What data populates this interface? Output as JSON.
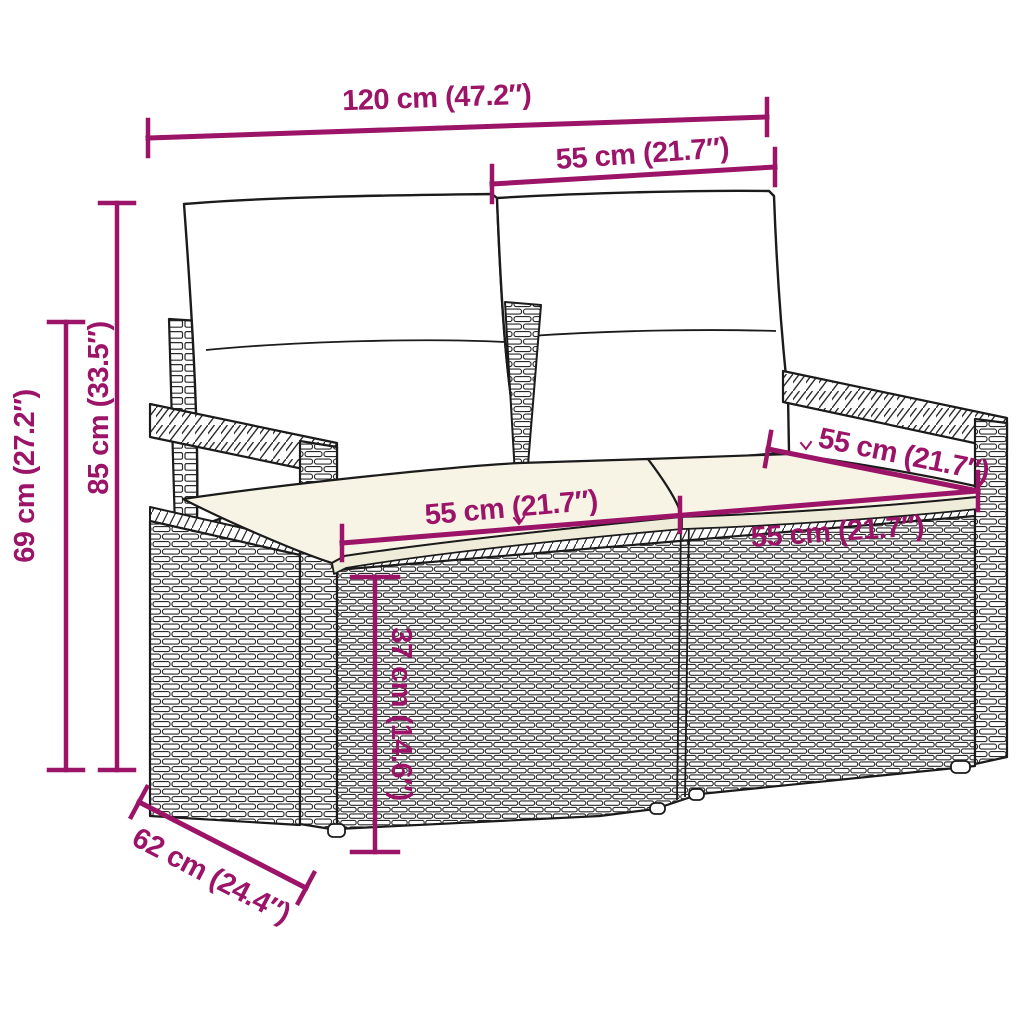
{
  "figure": {
    "kind": "product dimension diagram",
    "subject": "poly rattan garden loveseat (2-seater) with back and seat cushions"
  },
  "colors": {
    "dimension_magenta": "#9B1468",
    "outline_black": "#1b1b1b",
    "cushion_cream_top": "#F7F4E6",
    "cushion_cream_side": "#EFECDA",
    "background": "#ffffff"
  },
  "dims": {
    "overall_width": {
      "label": "120 cm (47.2″)"
    },
    "seat_width_top": {
      "label": "55 cm (21.7″)"
    },
    "back_height": {
      "label": "85 cm (33.5″)"
    },
    "arm_height": {
      "label": "69 cm (27.2″)"
    },
    "seat_width_left": {
      "label": "55 cm (21.7″)"
    },
    "seat_width_right": {
      "label": "55 cm (21.7″)"
    },
    "seat_depth": {
      "label": "55 cm (21.7″)"
    },
    "seat_height": {
      "label": "37 cm (14.6″)"
    },
    "overall_depth": {
      "label": "62 cm (24.4″)"
    }
  }
}
